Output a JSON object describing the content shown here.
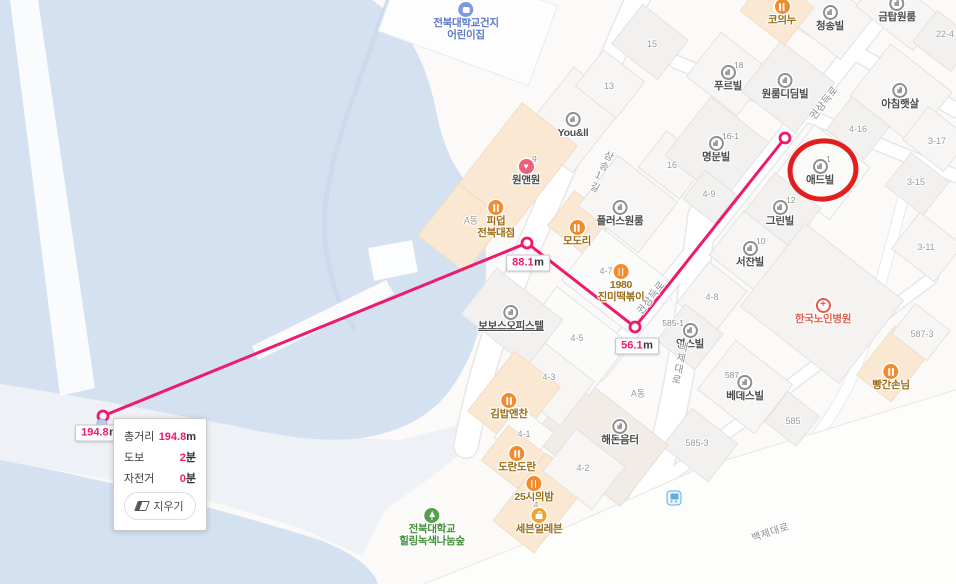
{
  "map": {
    "colors": {
      "measure_line": "#ee1a6e",
      "annotation": "#e11212",
      "water": "#d4e1f1"
    },
    "labels": [
      {
        "type": "school",
        "text": "전북대학교건지\n어린이집",
        "x": 466,
        "y": 10
      },
      {
        "type": "food",
        "text": "코의누",
        "x": 782,
        "y": 7
      },
      {
        "type": "building",
        "text": "청송빌",
        "x": 830,
        "y": 13
      },
      {
        "type": "building",
        "text": "금탑원룸",
        "x": 897,
        "y": 4
      },
      {
        "type": "parcel",
        "text": "22-4",
        "x": 945,
        "y": 34
      },
      {
        "type": "parcel",
        "text": "15",
        "x": 652,
        "y": 44
      },
      {
        "type": "parcel",
        "text": "13",
        "x": 609,
        "y": 86
      },
      {
        "type": "building",
        "text": "푸르빌",
        "x": 728,
        "y": 73,
        "badge": "18"
      },
      {
        "type": "building",
        "text": "원룸디딤빌",
        "x": 785,
        "y": 81
      },
      {
        "type": "building",
        "text": "아침햇살",
        "x": 900,
        "y": 91
      },
      {
        "type": "building",
        "text": "You&ll",
        "x": 573,
        "y": 120
      },
      {
        "type": "clinic",
        "text": "원앤원",
        "x": 526,
        "y": 167,
        "badge": "9"
      },
      {
        "type": "food",
        "text": "피덥\n전북대점",
        "x": 496,
        "y": 208
      },
      {
        "type": "parcel",
        "text": "A동",
        "x": 471,
        "y": 220
      },
      {
        "type": "building",
        "text": "명문빌",
        "x": 716,
        "y": 144,
        "badge": "16-1"
      },
      {
        "type": "parcel",
        "text": "16",
        "x": 672,
        "y": 165
      },
      {
        "type": "parcel",
        "text": "4-16",
        "x": 858,
        "y": 129
      },
      {
        "type": "parcel",
        "text": "3-17",
        "x": 937,
        "y": 141
      },
      {
        "type": "building",
        "text": "애드빌",
        "x": 820,
        "y": 167,
        "badge": "1"
      },
      {
        "type": "parcel",
        "text": "3-15",
        "x": 916,
        "y": 182
      },
      {
        "type": "building",
        "text": "플러스원룸",
        "x": 620,
        "y": 208
      },
      {
        "type": "food",
        "text": "모도리",
        "x": 577,
        "y": 228
      },
      {
        "type": "building",
        "text": "그린빌",
        "x": 780,
        "y": 208,
        "badge": "12"
      },
      {
        "type": "parcel",
        "text": "4-9",
        "x": 709,
        "y": 194
      },
      {
        "type": "parcel",
        "text": "3-11",
        "x": 926,
        "y": 247
      },
      {
        "type": "building",
        "text": "서찬빌",
        "x": 750,
        "y": 249,
        "badge": "10"
      },
      {
        "type": "food",
        "text": "1980\n진미떡볶이",
        "x": 621,
        "y": 272
      },
      {
        "type": "parcel",
        "text": "4-7",
        "x": 606,
        "y": 271
      },
      {
        "type": "parcel",
        "text": "4-8",
        "x": 712,
        "y": 297
      },
      {
        "type": "hospital",
        "text": "한국노인병원",
        "x": 823,
        "y": 306
      },
      {
        "type": "building",
        "text": "보보스오피스텔",
        "x": 511,
        "y": 313,
        "underline": true
      },
      {
        "type": "building",
        "text": "영스빌",
        "x": 690,
        "y": 331,
        "badge": "585-1",
        "badge_side": "left"
      },
      {
        "type": "parcel",
        "text": "587-3",
        "x": 922,
        "y": 334
      },
      {
        "type": "parcel",
        "text": "4-5",
        "x": 577,
        "y": 338
      },
      {
        "type": "food",
        "text": "빵간손님",
        "x": 891,
        "y": 372
      },
      {
        "type": "building",
        "text": "베데스빌",
        "x": 745,
        "y": 383,
        "badge": "587",
        "badge_side": "left"
      },
      {
        "type": "parcel",
        "text": "4-3",
        "x": 549,
        "y": 377
      },
      {
        "type": "food",
        "text": "김밥앤찬",
        "x": 509,
        "y": 401
      },
      {
        "type": "parcel",
        "text": "585",
        "x": 793,
        "y": 421
      },
      {
        "type": "parcel",
        "text": "A동",
        "x": 638,
        "y": 393
      },
      {
        "type": "building",
        "text": "해돈음터",
        "x": 620,
        "y": 427
      },
      {
        "type": "parcel",
        "text": "585-3",
        "x": 697,
        "y": 443
      },
      {
        "type": "parcel",
        "text": "4-1",
        "x": 524,
        "y": 434
      },
      {
        "type": "food",
        "text": "도란도란",
        "x": 517,
        "y": 454
      },
      {
        "type": "parcel",
        "text": "4-2",
        "x": 583,
        "y": 468
      },
      {
        "type": "food",
        "text": "25시의밤",
        "x": 534,
        "y": 484
      },
      {
        "type": "parcel",
        "text": "4",
        "x": 536,
        "y": 505
      },
      {
        "type": "store",
        "text": "세븐일레븐",
        "x": 539,
        "y": 516
      },
      {
        "type": "park",
        "text": "전북대학교\n힐링녹색나눔숲",
        "x": 432,
        "y": 516
      },
      {
        "type": "road",
        "text": "삼송1길",
        "x": 600,
        "y": 171,
        "rot": 24,
        "vertical": true
      },
      {
        "type": "road",
        "text": "백제대로",
        "x": 678,
        "y": 363,
        "rot": 12,
        "vertical": true
      },
      {
        "type": "road",
        "text": "백제대로",
        "x": 770,
        "y": 531,
        "rot": -18
      },
      {
        "type": "road",
        "text": "권삼득로",
        "x": 823,
        "y": 102,
        "rot": -52
      },
      {
        "type": "road",
        "text": "권삼득로",
        "x": 650,
        "y": 297,
        "rot": -52
      },
      {
        "type": "transit",
        "text": "",
        "x": 674,
        "y": 498
      },
      {
        "type": "poi-dot",
        "text": "",
        "x": 102,
        "y": 424
      }
    ],
    "measurement": {
      "points": [
        [
          785,
          138
        ],
        [
          635,
          327
        ],
        [
          527,
          243
        ],
        [
          103,
          416
        ]
      ],
      "labels": [
        {
          "value": "56.1",
          "unit": "m",
          "x": 637,
          "y": 346
        },
        {
          "value": "88.1",
          "unit": "m",
          "x": 528,
          "y": 263
        },
        {
          "value": "194.8",
          "unit": "m",
          "x": 100,
          "y": 433
        }
      ]
    },
    "annotation_circle": {
      "cx": 823,
      "cy": 170,
      "rx": 33,
      "ry": 29,
      "rot": -8
    },
    "tooltip": {
      "rows": [
        {
          "label": "총거리",
          "value": "194.8",
          "unit": "m"
        },
        {
          "label": "도보",
          "value": "2",
          "unit": "분"
        },
        {
          "label": "자전거",
          "value": "0",
          "unit": "분"
        }
      ],
      "clear_button": "지우기"
    }
  }
}
